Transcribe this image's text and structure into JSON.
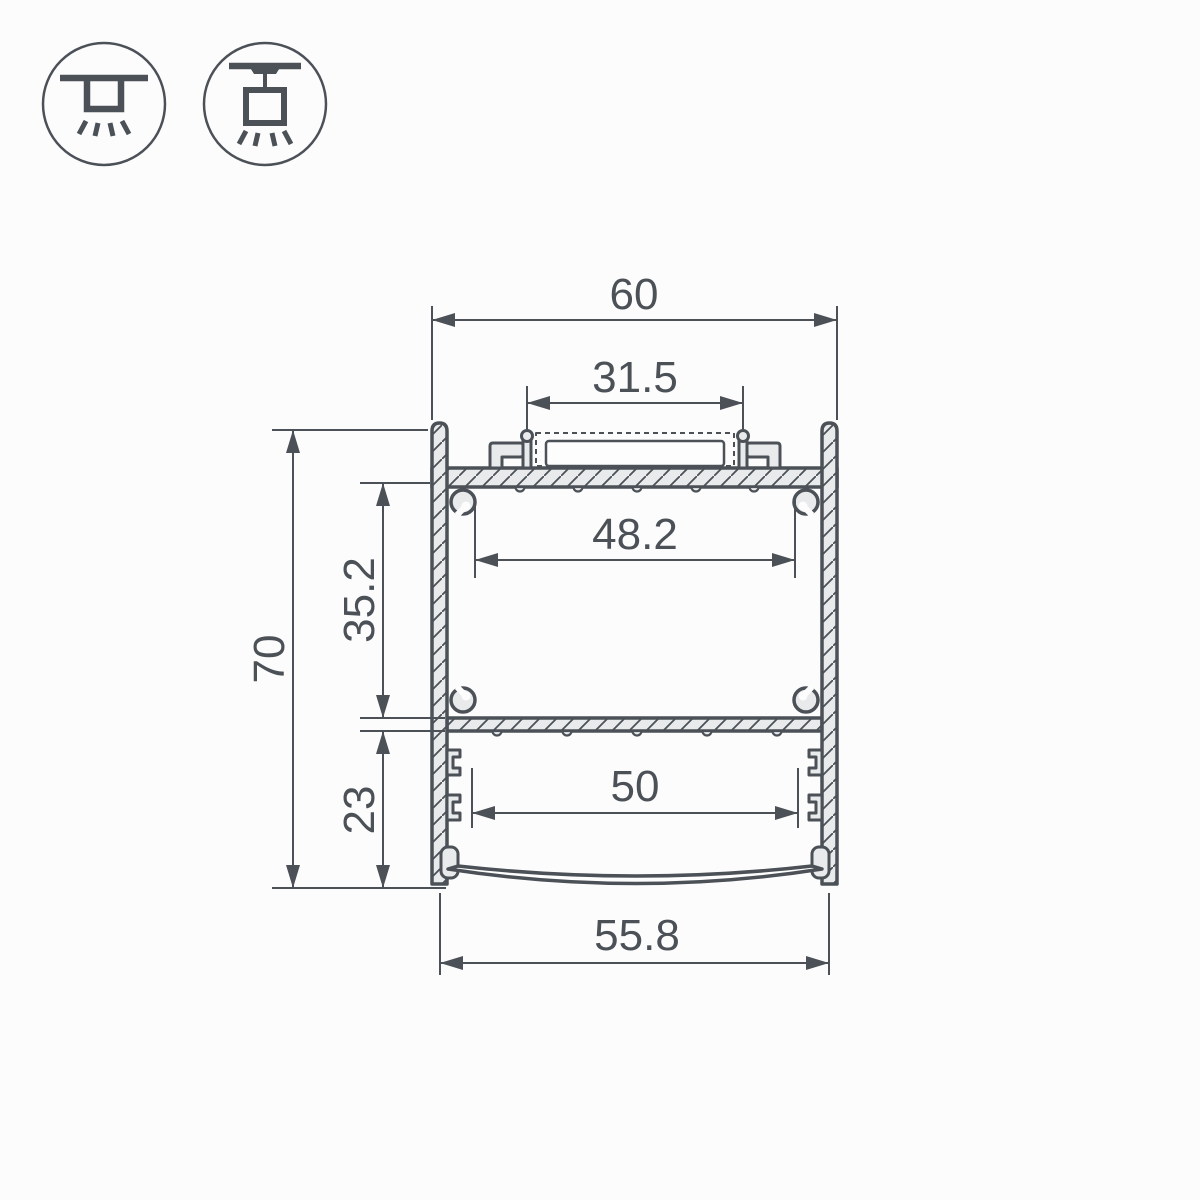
{
  "page": {
    "background": "#fcfcfd"
  },
  "colors": {
    "line": "#4b5157",
    "material_fill": "#e9eaec",
    "interior_fill": "#fdfdfd"
  },
  "icons": [
    {
      "id": "surface-mount",
      "meaning": "surface ceiling mounted luminaire"
    },
    {
      "id": "pendant-mount",
      "meaning": "suspended pendant luminaire"
    }
  ],
  "drawing": {
    "kind": "aluminium LED profile cross-section with dimensions",
    "dimensions": {
      "overall_width": "60",
      "led_slot_width": "31.5",
      "upper_chamber_width": "48.2",
      "upper_chamber_height": "35.2",
      "overall_height": "70",
      "lower_chamber_height": "23",
      "lower_chamber_width": "50",
      "diffuser_width": "55.8"
    }
  }
}
